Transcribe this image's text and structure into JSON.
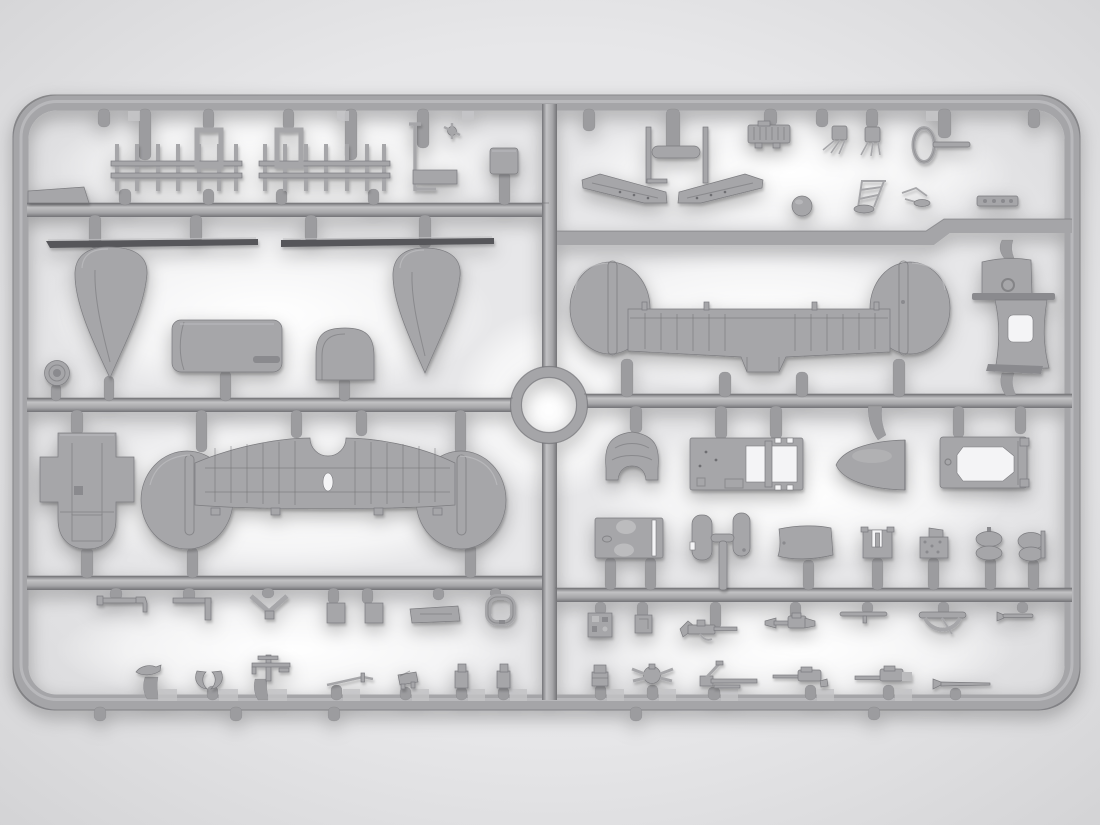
{
  "scene": {
    "title": "Gray injection-molded plastic model kit sprue with biplane aircraft parts on a backlit white studio background",
    "object": "model-kit-sprue",
    "material": "gray polystyrene",
    "background": "soft white vignette backdrop",
    "text_visible": "none"
  },
  "colors": {
    "bg-outer": "#d2d2d4",
    "bg-mid": "#e7e7e9",
    "glow": "#ffffff",
    "rail": "#a5a5a8",
    "rail-light": "#c2c2c4",
    "rail-dark": "#737377",
    "gate": "#9c9c9f",
    "part": "#a6a6a9",
    "part-light": "#bcbcbe",
    "part-dark": "#8a8a8e",
    "edge": "#7b7b7f",
    "strip": "#56565a",
    "hole": "#f4f4f6",
    "detail": "#6e6e72",
    "shadow": "#000000"
  },
  "sprue": {
    "frame": "rounded rectangle with internal rails and a central ring hub",
    "sections": [
      {
        "id": "top-left",
        "parts": [
          "strut-ladder-1",
          "strut-ladder-2",
          "wedge-block",
          "l-rod-antenna",
          "flat-plate",
          "small-box"
        ]
      },
      {
        "id": "mid-left",
        "parts": [
          "spar-strip-1",
          "spar-strip-2",
          "wingtip-float-left",
          "wingtip-float-right",
          "fuel-tank-cylinder",
          "headrest-dome",
          "tail-wheel"
        ]
      },
      {
        "id": "lower-left",
        "parts": [
          "engine-cowling-front",
          "lower-wing"
        ]
      },
      {
        "id": "bottom-left-row-1",
        "parts": [
          "hook-rod",
          "angle-bracket",
          "v-brace",
          "small-box-1",
          "small-box-2",
          "access-plate",
          "oval-frame"
        ]
      },
      {
        "id": "bottom-left-row-2",
        "parts": [
          "exhaust-stub",
          "wishbone-fork",
          "antenna-mast",
          "control-rod",
          "seat-bracket",
          "seat-post-1",
          "seat-post-2"
        ]
      },
      {
        "id": "top-right",
        "parts": [
          "float-spreader-bar",
          "elevator-half-left",
          "elevator-half-right",
          "engine-block",
          "gun-mount-1",
          "gun-mount-2",
          "ring-sight",
          "control-ball",
          "jack-frame",
          "control-linkage",
          "valve-manifold"
        ]
      },
      {
        "id": "wing-right",
        "parts": [
          "upper-wing",
          "fuselage-deck-panel",
          "fuselage-side-panel"
        ]
      },
      {
        "id": "mid-right-row-1",
        "parts": [
          "cowl-hood",
          "cockpit-floor-frame",
          "nose-cone",
          "fuselage-bulkhead-frame"
        ]
      },
      {
        "id": "mid-right-row-2",
        "parts": [
          "tank-end-plate",
          "bulkhead-pair-with-column",
          "curved-cowl-panel",
          "u-bracket",
          "instrument-panel",
          "wheel-pair",
          "bomb-pair"
        ]
      },
      {
        "id": "bottom-right-row-1",
        "parts": [
          "equipment-plate",
          "junction-box",
          "machine-gun-1",
          "machine-gun-2",
          "gun-barrel-rod",
          "windscreen-bow",
          "pitot-tube"
        ]
      },
      {
        "id": "bottom-right-row-2",
        "parts": [
          "ammo-box",
          "gun-swivel-mount",
          "gun-on-mount",
          "machine-gun-3",
          "machine-gun-4",
          "trumpet-exhaust"
        ]
      }
    ]
  }
}
